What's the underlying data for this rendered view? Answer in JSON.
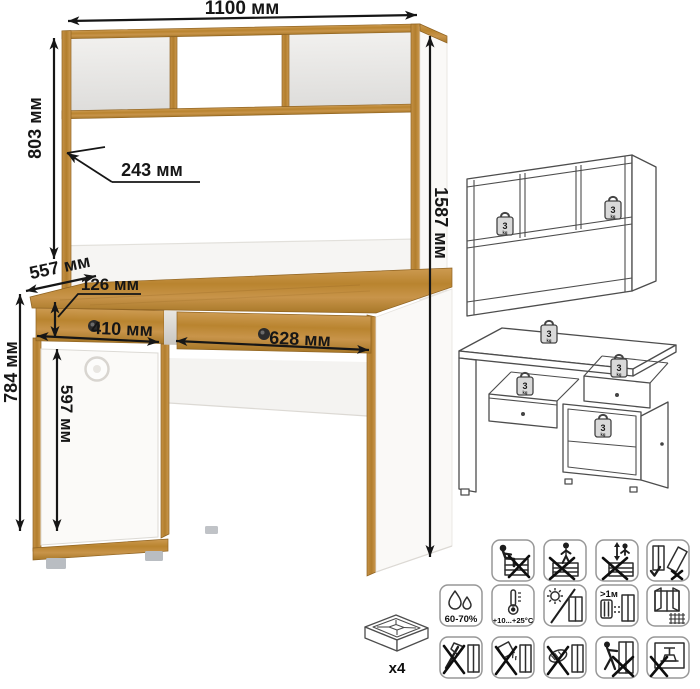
{
  "page": {
    "background": "#ffffff"
  },
  "colors": {
    "wood": "#c08c3e",
    "wood_edge": "#8f6322",
    "panel_white": "#f8f7f5",
    "line_art": "#4d4d4d",
    "dimension_text": "#161616",
    "feet_gray": "#b9bdc2"
  },
  "dimensions": {
    "top_width": "1100 мм",
    "hutch_height": "803 мм",
    "shelf_depth": "243 мм",
    "total_height": "1587 мм",
    "desk_depth": "557 мм",
    "drawer_front_height": "126 мм",
    "left_drawer_width": "410 мм",
    "right_drawer_width": "628 мм",
    "desk_height": "784 мм",
    "door_height": "597 мм"
  },
  "load": {
    "value": "3",
    "unit": "kg"
  },
  "hardware": {
    "feet_count_label": "x4"
  },
  "care": {
    "humidity_range": "60-70%",
    "temperature_range": "+10...+25°C",
    "heater_distance": ">1м"
  },
  "icon_legend": {
    "row1": [
      "no-sitting-on-furniture",
      "no-standing-on-furniture",
      "no-jumping-on-furniture",
      "keep-upright-during-transport"
    ],
    "row2": [
      "humidity-range",
      "temperature-range",
      "avoid-direct-sunlight",
      "keep-distance-from-heaters",
      "ventilate-room"
    ],
    "row3": [
      "no-sharp-tools",
      "no-spilling-liquids",
      "no-abrasive-cleaning",
      "do-not-drag",
      "do-not-overload"
    ]
  },
  "views": [
    "hutch-load-diagram",
    "desk-load-diagram",
    "foot-glide-x4"
  ]
}
